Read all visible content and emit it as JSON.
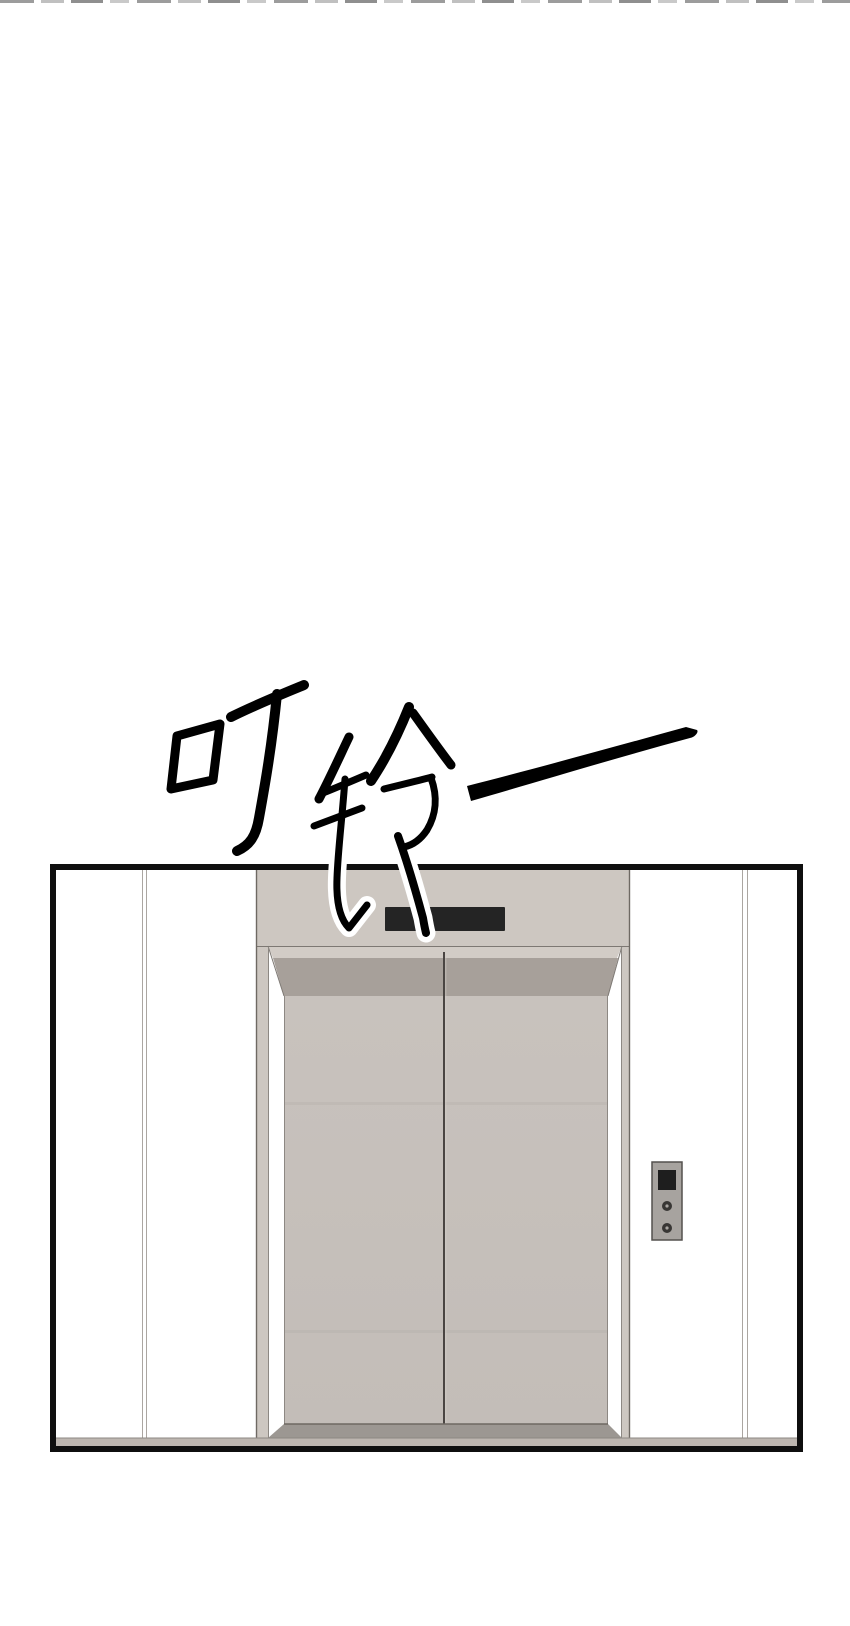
{
  "scene": {
    "type": "comic-panel",
    "sfx": {
      "text": "叮铃—"
    },
    "top_edge_marks_color": "#9c9c9c",
    "panel": {
      "border_color": "#0f0f0f",
      "wall_color": "#ffffff",
      "elevator": {
        "front_color": "#cdc7c1",
        "door_color": "#c7c1bc",
        "lintel_bevel_color": "#d2ccc6",
        "lintel_shadow_color": "#a7a09a",
        "door_split_color": "#4a4542",
        "sill_color": "#9c9792",
        "floor_strip_color": "#bdb6b0",
        "indicator_display_color": "#242424",
        "call_panel": {
          "plate_color": "#a7a39f",
          "screen_color": "#1e1e1e",
          "button_color": "#383634",
          "button_count": 2
        }
      }
    }
  }
}
